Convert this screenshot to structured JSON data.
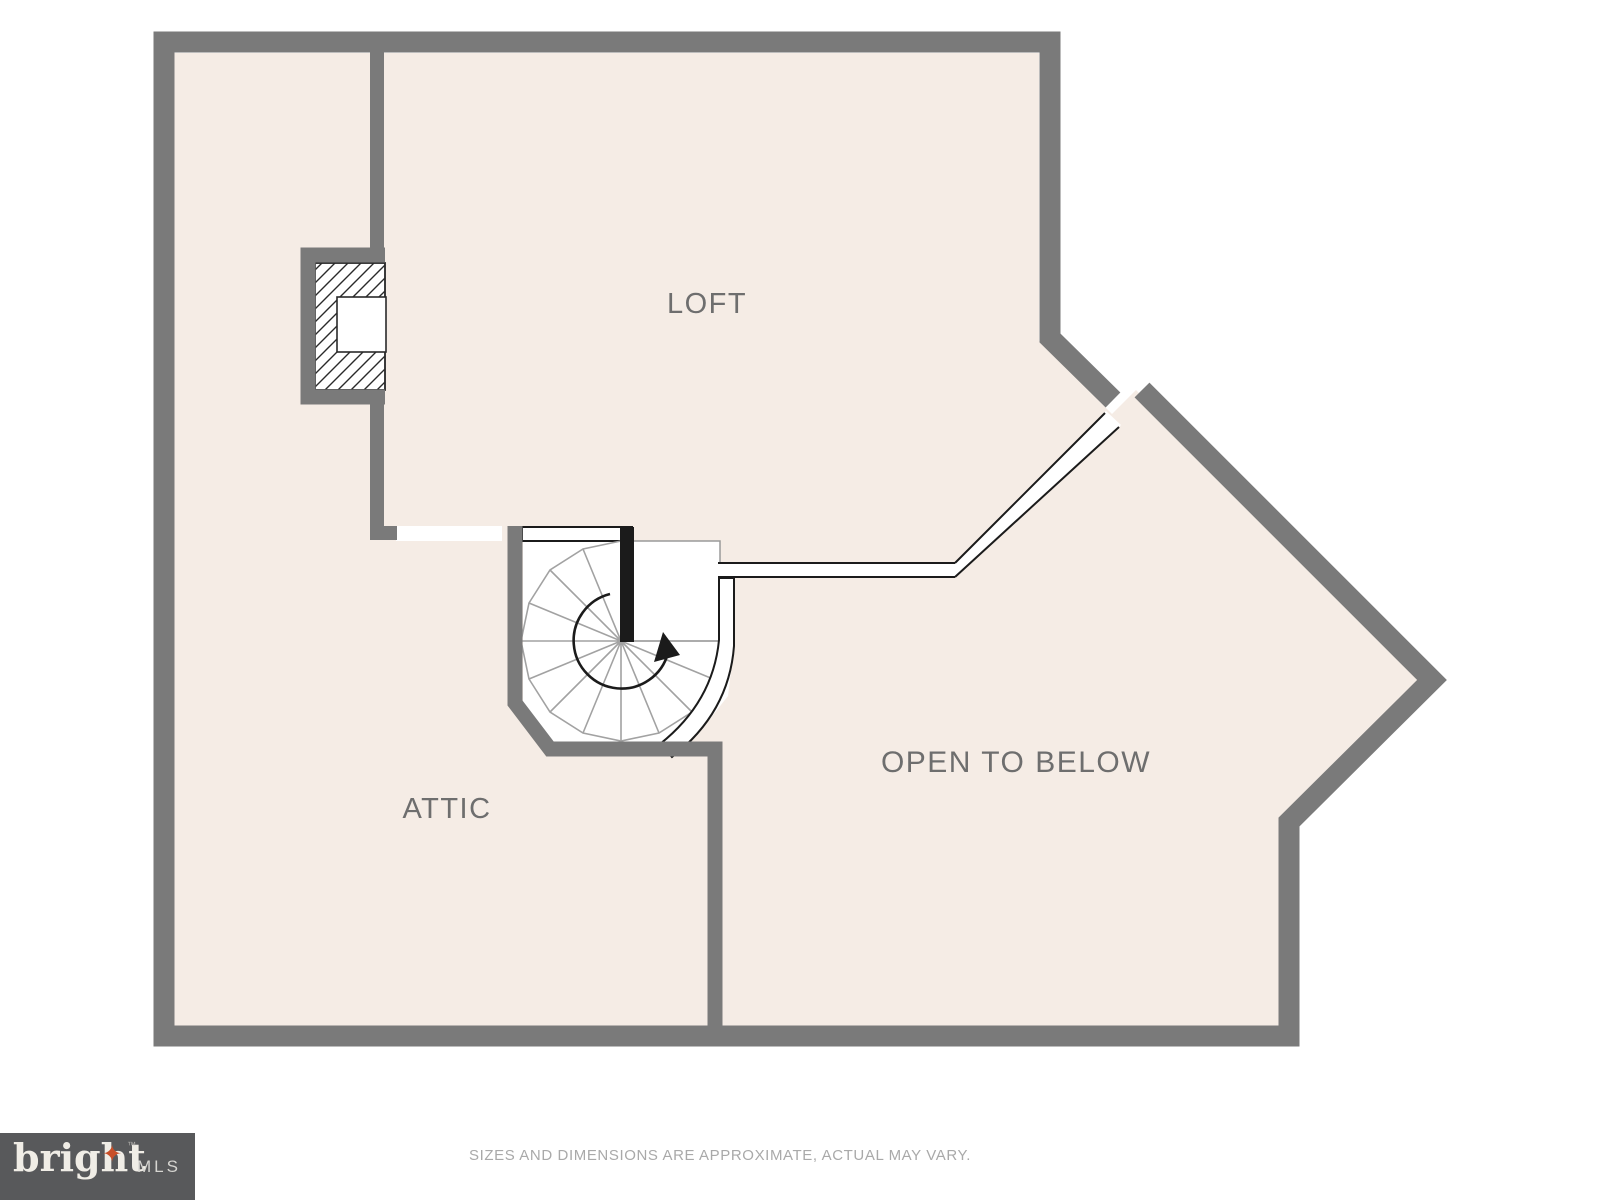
{
  "colors": {
    "wall-color": "#7a7a7a",
    "floor-color": "#f5ece5",
    "label-color": "#6e6e6e",
    "line-color": "#1b1b1b",
    "tread-color": "#a2a2a2",
    "accent": "#c94f28",
    "logo-bg": "#58595b",
    "disclaimer-color": "#a9a9a9"
  },
  "plan": {
    "rooms": [
      {
        "id": "loft",
        "label": "LOFT"
      },
      {
        "id": "attic",
        "label": "ATTIC"
      },
      {
        "id": "open-to-below",
        "label": "OPEN TO BELOW"
      }
    ],
    "features": [
      {
        "id": "spiral-staircase"
      },
      {
        "id": "chimney"
      },
      {
        "id": "stair-landing"
      },
      {
        "id": "open-to-below-railing"
      }
    ]
  },
  "footer": {
    "disclaimer": "SIZES AND DIMENSIONS ARE APPROXIMATE, ACTUAL MAY VARY.",
    "logo": {
      "brand": "bright",
      "star": "✦",
      "tm": "™",
      "suffix": "MLS"
    }
  }
}
